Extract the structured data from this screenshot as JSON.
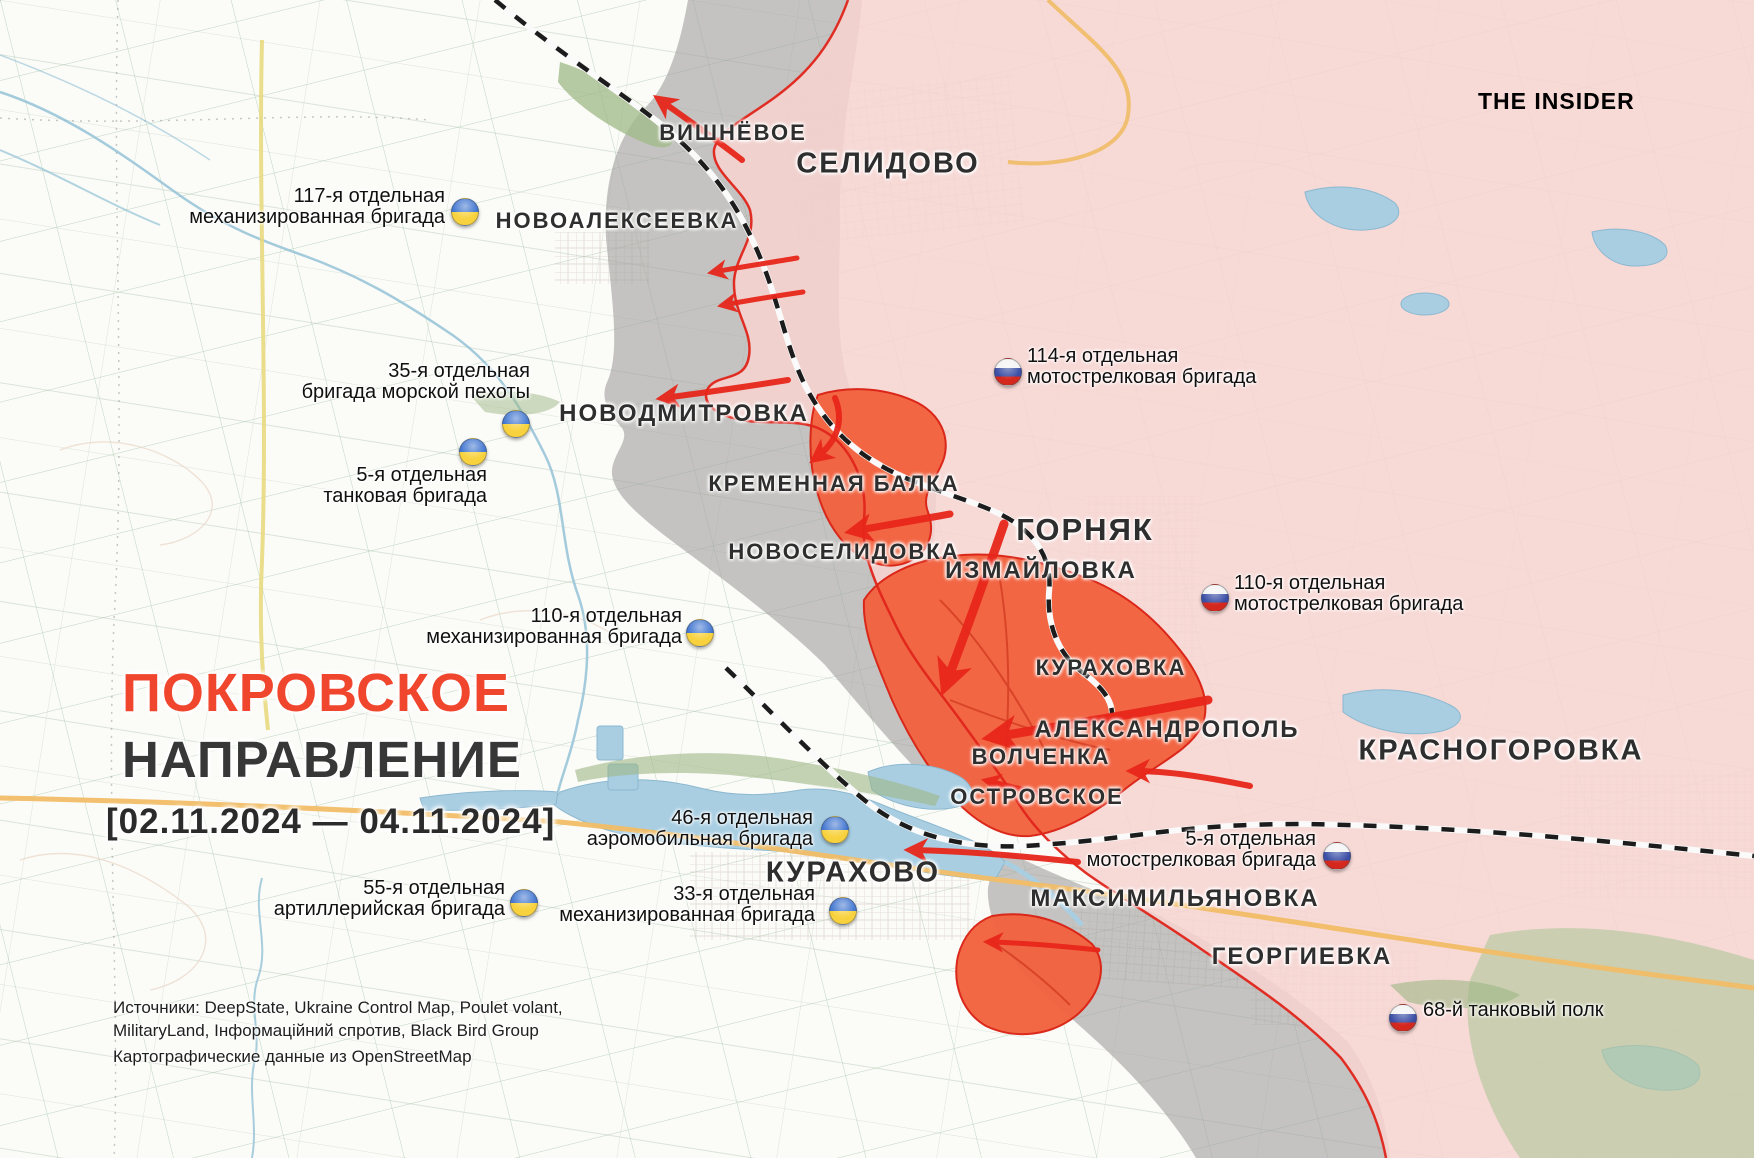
{
  "branding": {
    "logo_text": "THE INSIDER"
  },
  "title_block": {
    "heading_accent": "ПОКРОВСКОЕ",
    "heading_main": "НАПРАВЛЕНИЕ",
    "date_range": "[02.11.2024 — 04.11.2024]"
  },
  "credits": {
    "line1": "Источники: DeepState, Ukraine Control Map, Poulet volant,",
    "line2": "MilitaryLand, Інформаційний спротив, Black Bird Group",
    "line3": "Картографические данные из OpenStreetMap"
  },
  "map": {
    "towns": [
      {
        "name": "ВИШНЁВОЕ"
      },
      {
        "name": "СЕЛИДОВО"
      },
      {
        "name": "НОВОАЛЕКСЕЕВКА"
      },
      {
        "name": "НОВОДМИТРОВКА"
      },
      {
        "name": "КРЕМЕННАЯ БАЛКА"
      },
      {
        "name": "НОВОСЕЛИДОВКА"
      },
      {
        "name": "ГОРНЯК"
      },
      {
        "name": "ИЗМАЙЛОВКА"
      },
      {
        "name": "КУРАХОВКА"
      },
      {
        "name": "АЛЕКСАНДРОПОЛЬ"
      },
      {
        "name": "ВОЛЧЕНКА"
      },
      {
        "name": "ОСТРОВСКОЕ"
      },
      {
        "name": "КРАСНОГОРОВКА"
      },
      {
        "name": "КУРАХОВО"
      },
      {
        "name": "МАКСИМИЛЬЯНОВКА"
      },
      {
        "name": "ГЕОРГИЕВКА"
      }
    ],
    "units_ukraine": [
      {
        "line1": "117-я отдельная",
        "line2": "механизированная бригада"
      },
      {
        "line1": "35-я отдельная",
        "line2": "бригада морской пехоты"
      },
      {
        "line1": "5-я отдельная",
        "line2": "танковая бригада"
      },
      {
        "line1": "110-я отдельная",
        "line2": "механизированная бригада"
      },
      {
        "line1": "46-я отдельная",
        "line2": "аэромобильная бригада"
      },
      {
        "line1": "55-я отдельная",
        "line2": "артиллерийская бригада"
      },
      {
        "line1": "33-я отдельная",
        "line2": "механизированная бригада"
      }
    ],
    "units_russia": [
      {
        "line1": "114-я отдельная",
        "line2": "мотострелковая бригада"
      },
      {
        "line1": "110-я отдельная",
        "line2": "мотострелковая бригада"
      },
      {
        "line1": "5-я отдельная",
        "line2": "мотострелковая бригада"
      },
      {
        "line1": "68-й танковый полк",
        "line2": ""
      }
    ],
    "legend_colors": {
      "russian_controlled_pink": "#f6d4d0",
      "contested_gray": "#a09f9d",
      "recent_advance_orange": "#f2603c",
      "front_line_red": "#e0251b",
      "attack_arrow_red": "#e7261b",
      "water_blue": "#a9cee2",
      "title_accent_red": "#f0462e"
    }
  }
}
